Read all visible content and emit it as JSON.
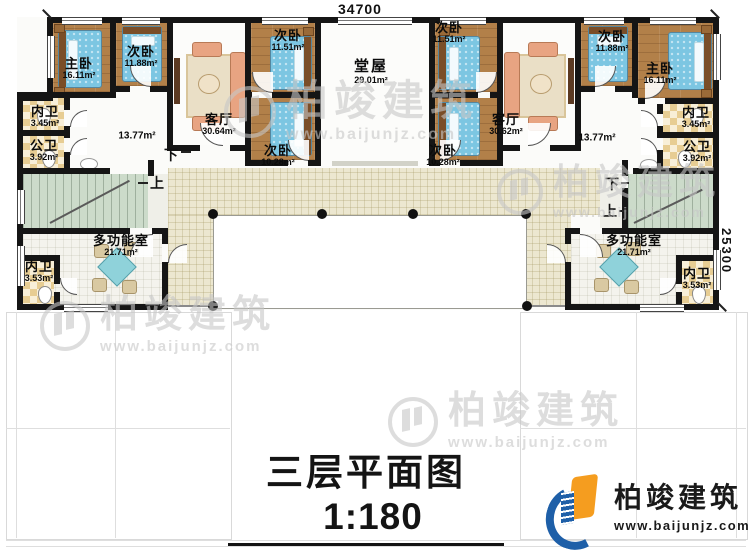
{
  "dims": {
    "top": "34700",
    "right": "25300"
  },
  "rooms": [
    {
      "name": "主卧",
      "area": "16.11m²"
    },
    {
      "name": "次卧",
      "area": "11.88m²"
    },
    {
      "name": "客厅",
      "area": "30.64m²"
    },
    {
      "name": "次卧",
      "area": "11.51m²"
    },
    {
      "name": "堂屋",
      "area": "29.01m²"
    },
    {
      "name": "次卧",
      "area": "11.51m²"
    },
    {
      "name": "客厅",
      "area": "30.62m²"
    },
    {
      "name": "次卧",
      "area": "11.88m²"
    },
    {
      "name": "主卧",
      "area": "16.11m²"
    },
    {
      "name": "内卫",
      "area": "3.45m²"
    },
    {
      "name": "公卫",
      "area": "3.92m²"
    },
    {
      "name": "",
      "area": "13.77m²"
    },
    {
      "name": "次卧",
      "area": "10.28m²"
    },
    {
      "name": "次卧",
      "area": "10.28m²"
    },
    {
      "name": "",
      "area": "13.77m²"
    },
    {
      "name": "内卫",
      "area": "3.45m²"
    },
    {
      "name": "公卫",
      "area": "3.92m²"
    },
    {
      "name": "多功能室",
      "area": "21.71m²"
    },
    {
      "name": "多功能室",
      "area": "21.71m²"
    },
    {
      "name": "内卫",
      "area": "3.53m²"
    },
    {
      "name": "内卫",
      "area": "3.53m²"
    }
  ],
  "stairs": {
    "down": "下",
    "up": "上"
  },
  "title": {
    "main": "三层平面图",
    "scale": "1:180",
    "area_label": "本层建筑面积：",
    "area_value": "438.86m²",
    "height_label": "层高：",
    "height_value": "4.0m"
  },
  "brand": {
    "name": "柏竣建筑",
    "site": "www.baijunjz.com"
  },
  "watermark": {
    "name": "柏竣建筑",
    "site": "www.baijunjz.com"
  }
}
